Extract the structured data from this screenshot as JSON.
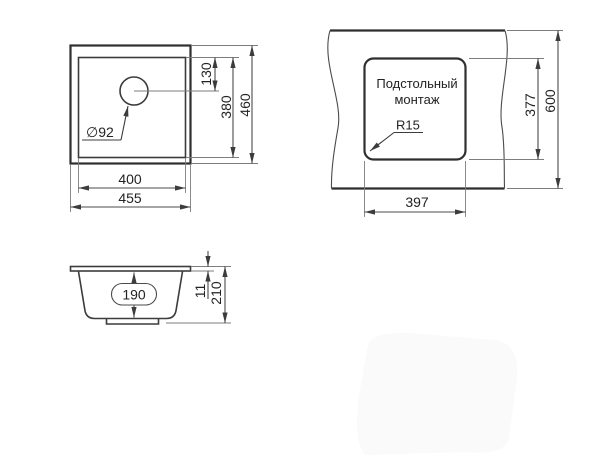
{
  "page": {
    "background": "#ffffff",
    "line_color": "#3c3c3c",
    "text_color": "#232323"
  },
  "views": {
    "top_view": {
      "dim_hole_offset": "130",
      "dim_bowl_height": "380",
      "dim_overall_height": "460",
      "dim_bowl_width": "400",
      "dim_overall_width": "455",
      "label_drain_diameter": "∅92"
    },
    "installation_view": {
      "label_line1": "Подстольный",
      "label_line2": "монтаж",
      "label_corner_radius": "R15",
      "dim_cutout_height": "377",
      "dim_countertop_depth": "600",
      "dim_cutout_width": "397"
    },
    "section_view": {
      "dim_bowl_depth": "190",
      "dim_rim_thickness": "11",
      "dim_overall_depth": "210"
    }
  }
}
